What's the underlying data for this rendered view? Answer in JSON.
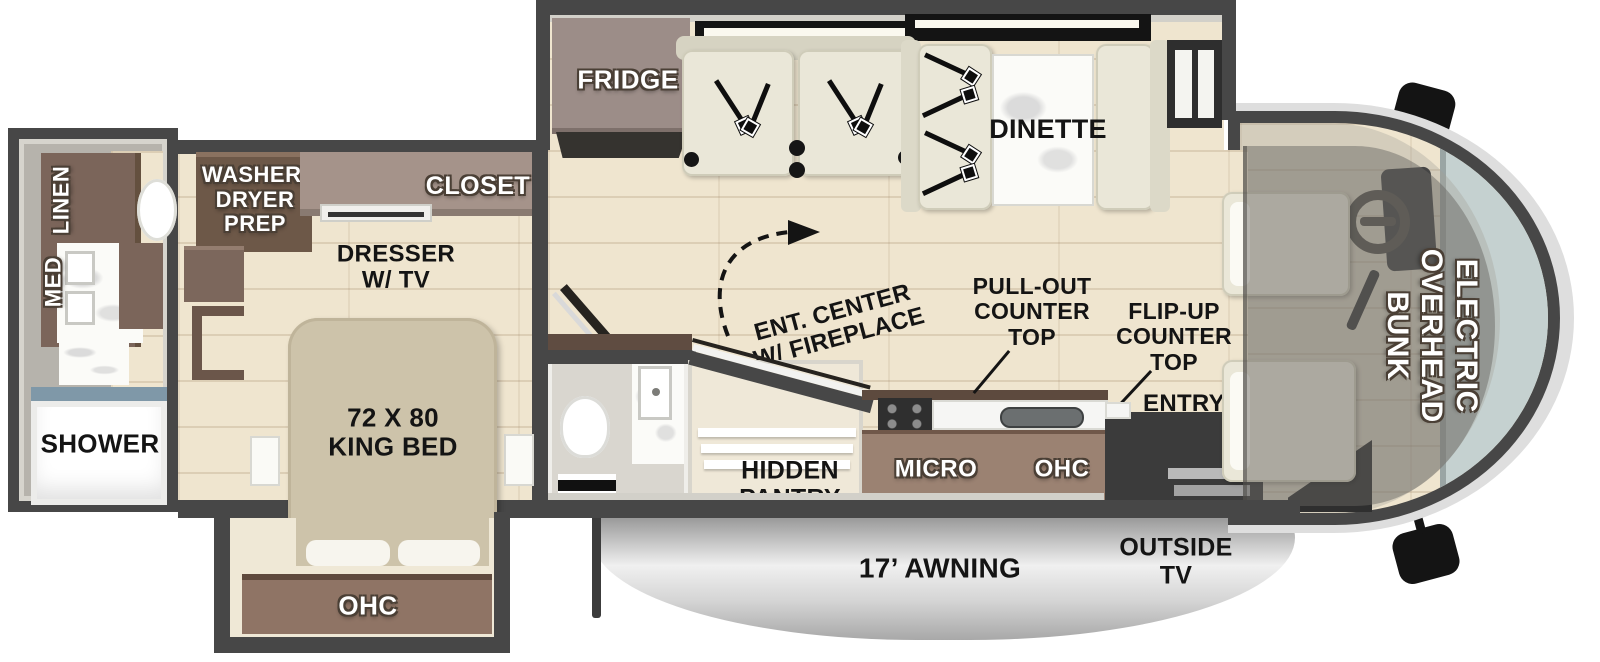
{
  "meta": {
    "kind": "rv-floorplan-diagram"
  },
  "palette": {
    "wall": "#474747",
    "floor_wood": "#efe5cf",
    "cabinet_dark_brown": "#6d5848",
    "cabinet_brown": "#8d7465",
    "cabinet_mauve": "#a2908a",
    "kitchen_cabinet": "#9b8272",
    "upholstery_cream": "#eae7d8",
    "marble_white": "#fbfbf8",
    "shower_glass_blue": "#7f98a8",
    "windshield_glass": "#c5d1d0",
    "awning_silver": "#c9c9c9",
    "label_black": "#141414",
    "label_white": "#ffffff"
  },
  "labels": {
    "rear_bath": {
      "med": "MED",
      "linen": "LINEN",
      "shower": "SHOWER"
    },
    "bedroom": {
      "washer_dryer_prep": "WASHER/\nDRYER\nPREP",
      "closet": "CLOSET",
      "dresser_tv": "DRESSER\nW/ TV",
      "king_bed": "72 X 80\nKING BED",
      "ohc": "OHC"
    },
    "living": {
      "fridge": "FRIDGE",
      "dinette": "DINETTE",
      "ent_center": "ENT. CENTER\nW/ FIREPLACE"
    },
    "kitchen": {
      "micro": "MICRO",
      "ohc": "OHC",
      "pull_out_counter": "PULL-OUT\nCOUNTER\nTOP",
      "flip_up_counter": "FLIP-UP\nCOUNTER\nTOP",
      "entry": "ENTRY",
      "hidden_pantry": "HIDDEN\nPANTRY"
    },
    "cab": {
      "overhead_bunk": "ELECTRIC\nOVERHEAD\nBUNK"
    },
    "exterior": {
      "awning": "17’ AWNING",
      "outside_tv": "OUTSIDE\nTV"
    }
  }
}
